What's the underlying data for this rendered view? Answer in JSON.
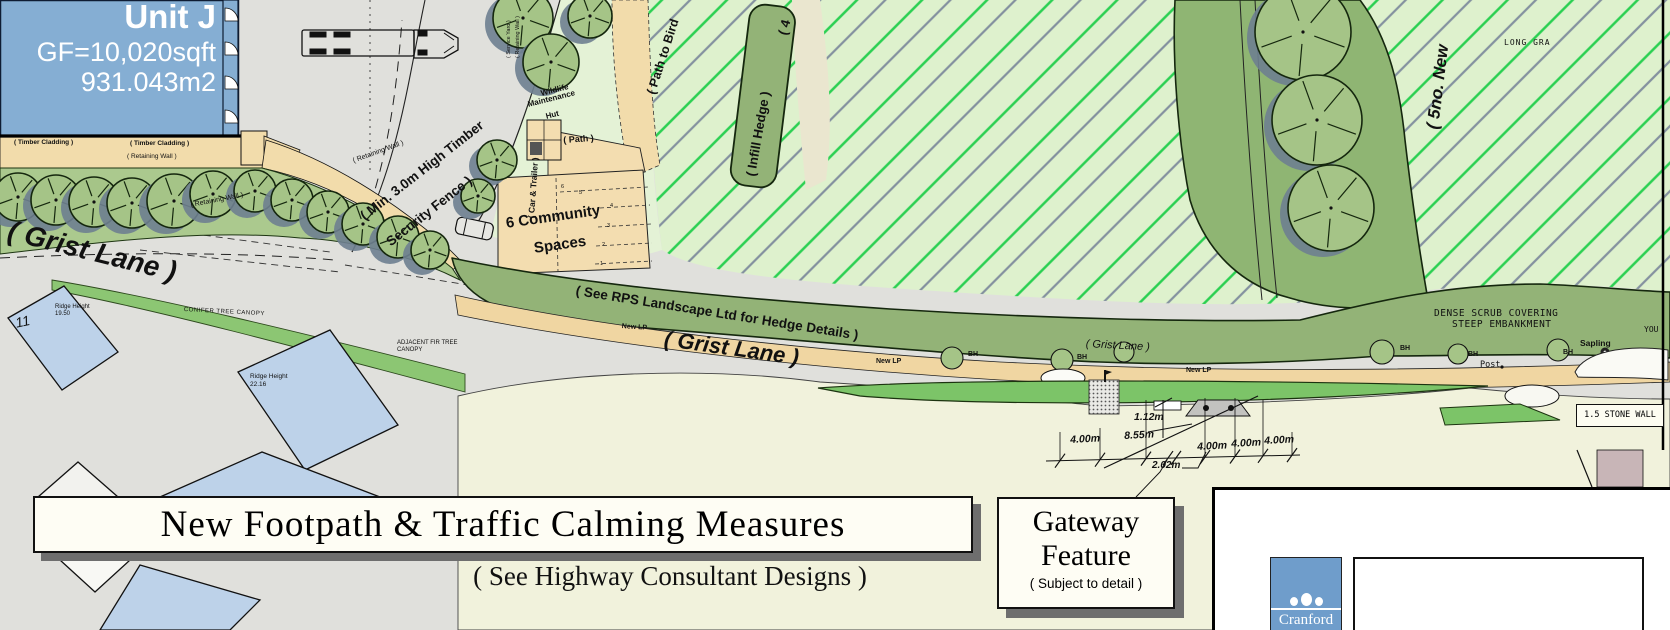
{
  "colors": {
    "building_blue": "#85aed3",
    "dark_blue_edge": "#0e1c33",
    "road_gray": "#e0e0dc",
    "cream": "#f1f2dc",
    "field_green": "#def1cd",
    "hatch_green": "#2bd052",
    "hatch_slate": "#84919f",
    "hedge_olive": "#93b377",
    "canopy_green": "#8fb573",
    "tree_green": "#a5c487",
    "tree_shadow": "#6e8090",
    "verge_green": "#7cc468",
    "tan": "#f2dcab",
    "house_blue": "#bdd2e9",
    "mauve": "#c8b5b7",
    "cranford_blue": "#6f9dcb"
  },
  "plan": {
    "unit_j": {
      "name": "Unit J",
      "area_sqft": "GF=10,020sqft",
      "area_m2": "931.043m2"
    },
    "labels": {
      "timber_cladding_1": "( Timber Cladding )",
      "timber_cladding_2": "( Timber Cladding )",
      "retaining_wall_1": "( Retaining Wall )",
      "retaining_wall_2": "( Retaining Wall )",
      "retaining_wall_3": "( Retaining Wall )",
      "service_yard_line1": "( Service Yard )",
      "service_yard_line2": "( Retaining Wall )",
      "fence_line1": "( Min. 3.0m High Timber",
      "fence_line2": "Security Fence )",
      "wildlife_line1": "Wildlife",
      "wildlife_line2": "Maintenance",
      "wildlife_line3": "Hut",
      "path": "( Path )",
      "path_to_bird": "( Path to Bird",
      "infill_hedge": "( Infill Hedge )",
      "hedge_fragment": "( 4",
      "grist_lane_left": "( Grist Lane )",
      "grist_lane_center": "( Grist Lane )",
      "grist_lane_small": "( Grist Lane )",
      "rps_hedge_note": "( See RPS Landscape Ltd for Hedge Details )",
      "community_line1": "6 Community",
      "community_line2": "Spaces",
      "car_trailer": "( Car & Trailer )",
      "five_new": "( 5no. New",
      "long_grass": "LONG GRA",
      "dense_scrub_line1": "DENSE SCRUB COVERING",
      "dense_scrub_line2": "STEEP EMBANKMENT",
      "young_fragment": "YOU",
      "sapling": "Sapling",
      "post": "Post",
      "stone_wall": "1.5 STONE WALL",
      "conifer": "CONIFER TREE CANOPY",
      "adjacent_fir_line1": "ADJACENT FIR TREE",
      "adjacent_fir_line2": "CANOPY",
      "ridge_height": "Ridge Height",
      "ridge_value_1": "19.50",
      "ridge_value_2": "22.16",
      "plot_number": "11"
    },
    "markers": {
      "bh": [
        "BH",
        "BH",
        "BH",
        "BH",
        "BH"
      ],
      "new_lp": [
        "New LP",
        "New LP",
        "New LP"
      ],
      "bays": [
        "6",
        "5",
        "4",
        "3",
        "2",
        "1"
      ]
    },
    "dimensions": {
      "row": [
        "4.00m",
        "8.55m",
        "4.00m",
        "4.00m",
        "4.00m"
      ],
      "height": "1.12m",
      "offset": "2.02m"
    }
  },
  "title_block": {
    "title": "New Footpath & Traffic Calming Measures",
    "subtitle": "( See Highway Consultant Designs )"
  },
  "gateway_box": {
    "line1": "Gateway",
    "line2": "Feature",
    "note": "( Subject to detail )"
  },
  "logo": {
    "name": "Cranford"
  }
}
